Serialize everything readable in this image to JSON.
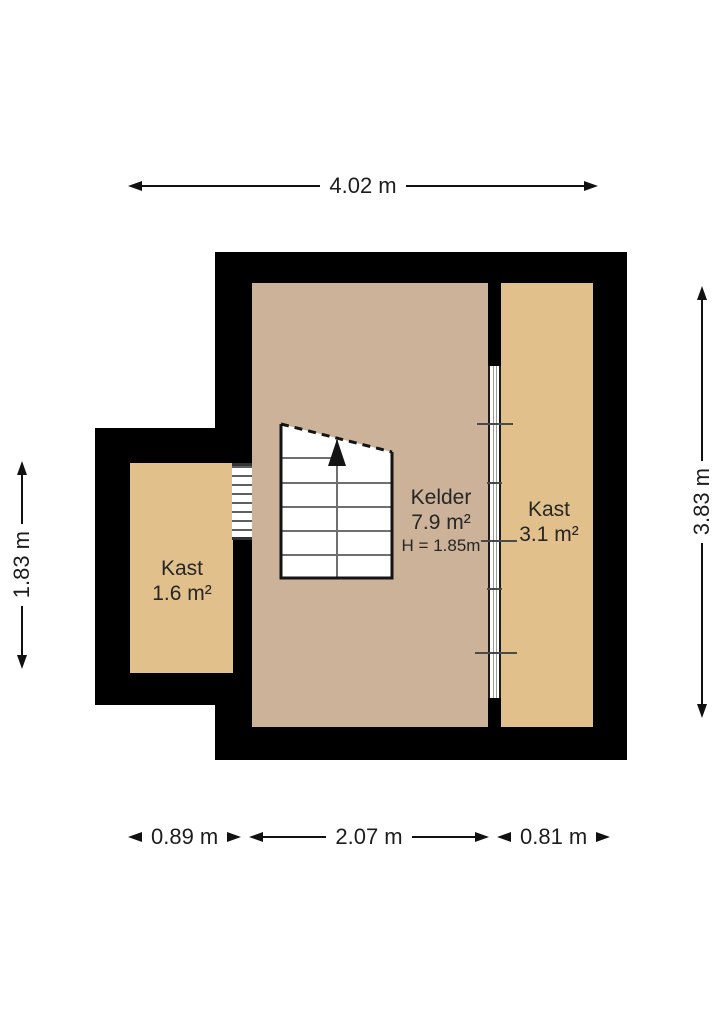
{
  "plan": {
    "rooms": {
      "kelder": {
        "name": "Kelder",
        "area": "7.9 m²",
        "height_note": "H = 1.85m"
      },
      "kast_right": {
        "name": "Kast",
        "area": "3.1 m²"
      },
      "kast_left": {
        "name": "Kast",
        "area": "1.6 m²"
      }
    },
    "dimensions": {
      "top": "4.02 m",
      "right": "3.83 m",
      "left": "1.83 m",
      "bottom_left": "0.89 m",
      "bottom_center": "2.07 m",
      "bottom_right": "0.81 m"
    },
    "colors": {
      "wall": "#000000",
      "kelder_floor": "#cbb299",
      "kast_floor": "#e2c08c",
      "background": "#ffffff",
      "text": "#262626"
    }
  }
}
